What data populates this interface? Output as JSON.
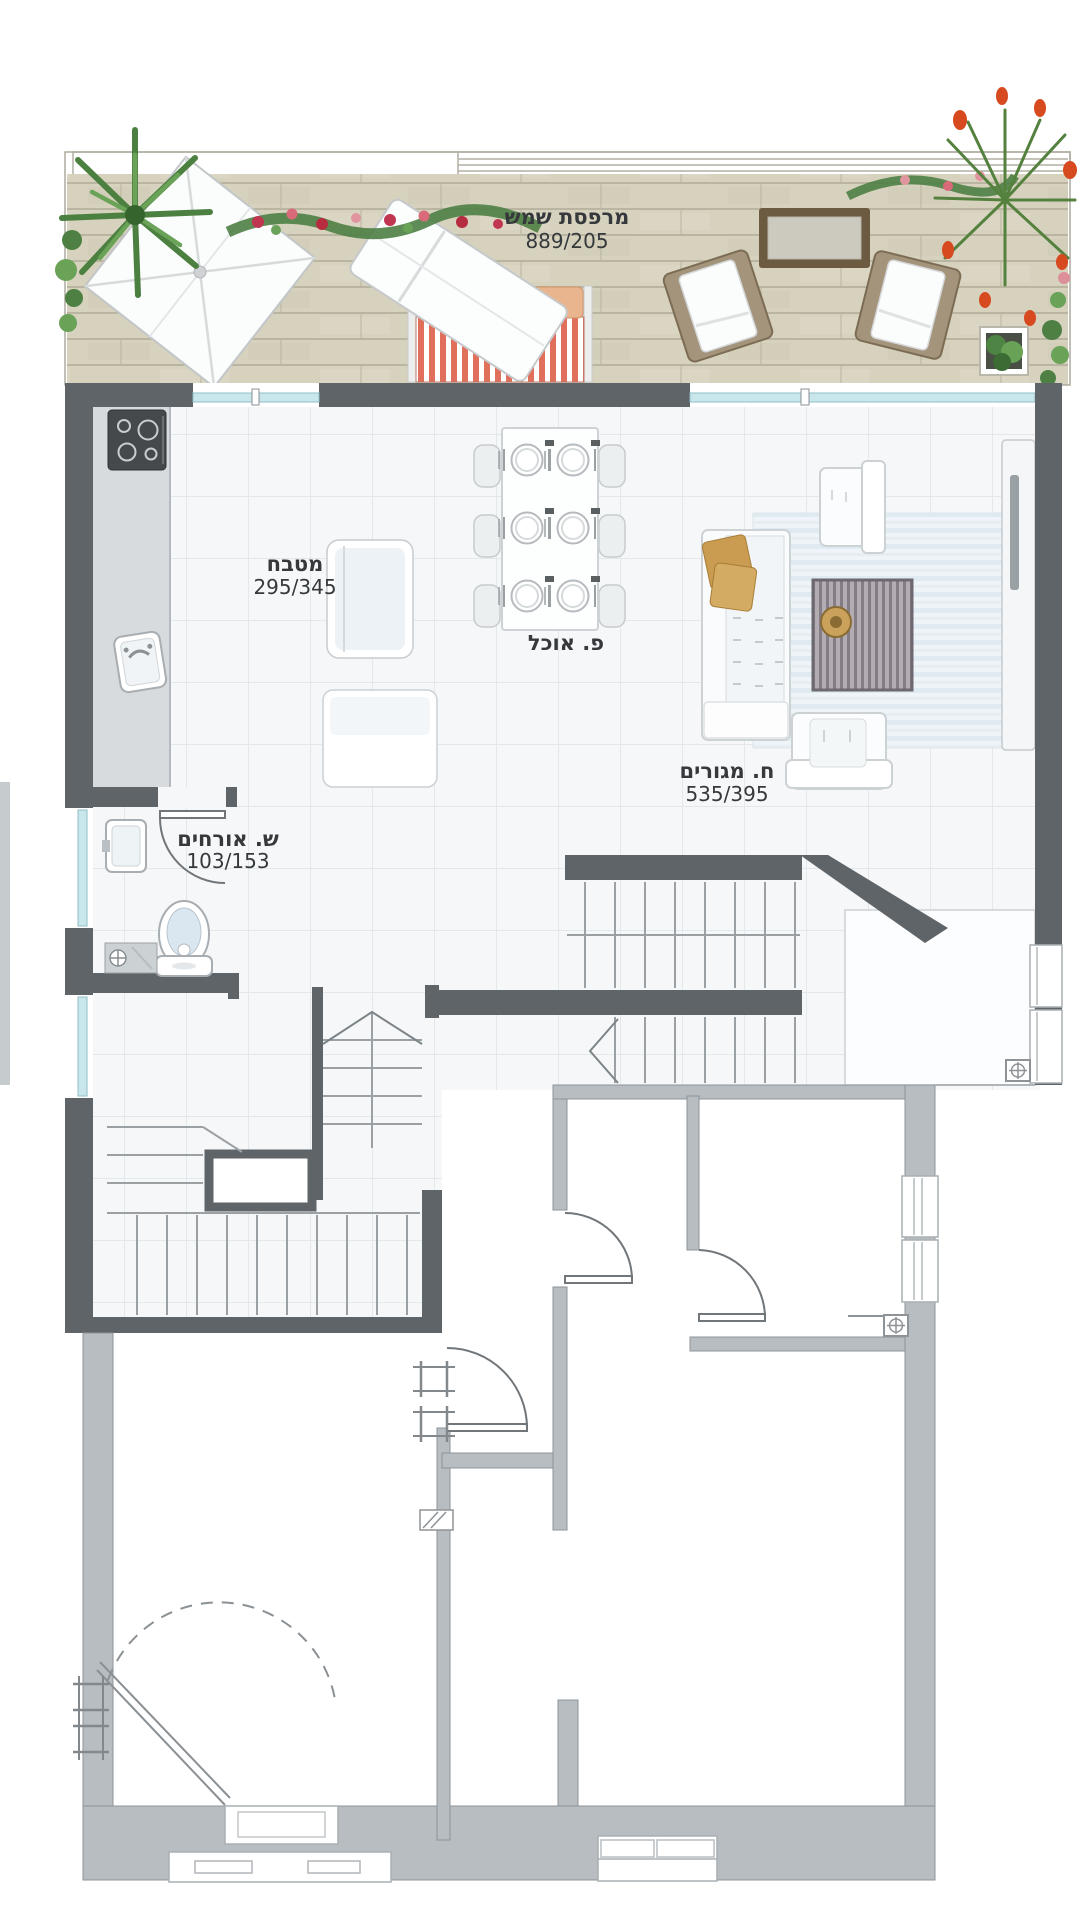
{
  "rooms": {
    "sun_terrace": {
      "name": "מרפסת שמש",
      "dims": "889/205"
    },
    "kitchen": {
      "name": "מטבח",
      "dims": "295/345"
    },
    "dining": {
      "name": "פ. אוכל"
    },
    "living": {
      "name": "ח. מגורים",
      "dims": "535/395"
    },
    "guest_bath": {
      "name": "ש. אורחים",
      "dims": "103/153"
    }
  },
  "icons": {
    "palm": "palm-plant-icon",
    "flowers": "flower-garland-icon",
    "parasol": "parasol-icon",
    "lounger": "sun-lounger-icon",
    "cooktop": "cooktop-icon",
    "sink": "sink-icon",
    "toilet": "toilet-icon",
    "washer": "washer-icon",
    "drain": "floor-drain-icon",
    "stair_arrow": "stair-direction-icon"
  },
  "colors": {
    "wall_dark": "#5e6467",
    "wall_light": "#b7bdc0",
    "deck_wood": "#d6d2be",
    "window_glass": "#c9e6eb",
    "sofa_stripe_red": "#e0705c",
    "cushion_peach": "#e9b58f",
    "pillow_gold": "#c99c52",
    "accent_rug": "#a099a1",
    "plant_green": "#4e8044",
    "flower_red": "#d7491f",
    "floor_tile": "#f5f7f9",
    "label_text": "#35393c"
  }
}
